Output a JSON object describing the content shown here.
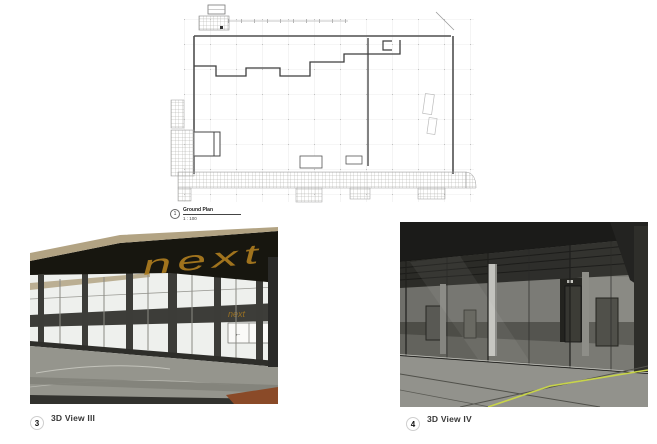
{
  "plan": {
    "number": "1",
    "title": "Ground Plan",
    "scale": "1 : 100"
  },
  "view3": {
    "number": "3",
    "title": "3D View III",
    "signage_large": "next",
    "signage_small": "next",
    "door_arrow_left": "←",
    "door_arrow_right": "→"
  },
  "view4": {
    "number": "4",
    "title": "3D View IV"
  },
  "colors": {
    "roof_tan": "#b2a383",
    "fascia_dark": "#17160f",
    "signage_gold": "#a8791e",
    "glass_light": "#eef0ed",
    "pavement_gray": "#95958d",
    "ground_brown": "#8a4a28",
    "floor_line_yellow": "#c8d44a",
    "plan_grid": "#d9d9d9",
    "plan_wall": "#4f4f4f"
  }
}
